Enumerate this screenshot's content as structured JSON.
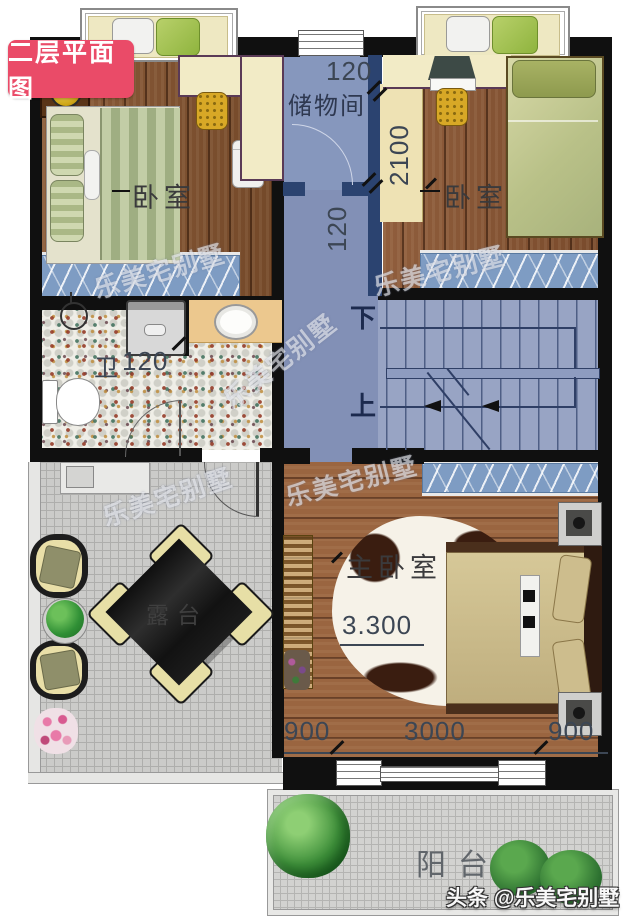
{
  "badge": {
    "title": "二层平面图"
  },
  "rooms": {
    "storage": {
      "label": "储物间"
    },
    "bedroom_left": {
      "label": "卧室"
    },
    "bedroom_right": {
      "label": "卧室"
    },
    "master_bedroom": {
      "label": "主卧室"
    },
    "bathroom": {
      "label": "卫"
    },
    "terrace": {
      "label": "露台"
    },
    "balcony": {
      "label": "阳台"
    },
    "stairs": {
      "down": "下",
      "up": "上"
    }
  },
  "dims": {
    "storage_top": "120",
    "closet_right": "2100",
    "hall_wall": "120",
    "bathroom": "120",
    "master_elevation": "3.300",
    "master_left": "900",
    "master_center": "3000",
    "master_right": "900"
  },
  "watermark": {
    "text": "乐美宅别墅"
  },
  "credit": {
    "text": "头条 @乐美宅别墅"
  },
  "colors": {
    "badge_bg": "#ea4b68",
    "wall": "#101010",
    "partition_navy": "#2b4370",
    "corridor_floor": "#8290b6",
    "stairs_floor": "#98a4c4",
    "wood_dark": "#84532f",
    "wood_light": "#9a6540",
    "terrace_tile": "#cbcbc9",
    "window_glass": "#7e9cc3",
    "desk_cream": "#f2ebc6",
    "dimension_text": "#3c4654"
  }
}
